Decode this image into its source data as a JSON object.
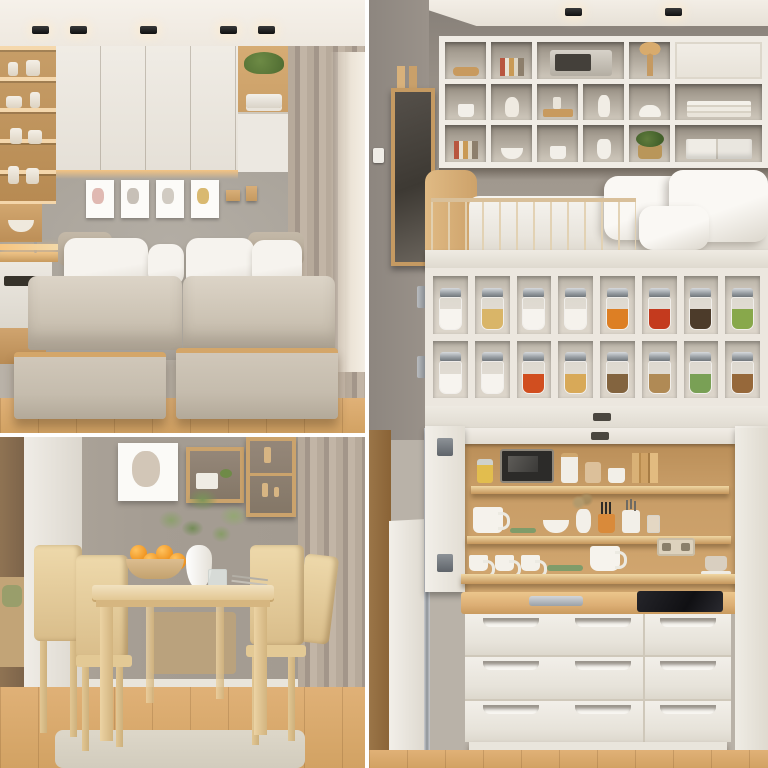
{
  "meta": {
    "kind": "photo-collage",
    "title": "Space-saving small apartment interiors — 3-photo collage",
    "layout": "two stacked photos left, one tall photo right, thin white dividers"
  },
  "palette": {
    "divider": "#ffffff",
    "ceiling": "#f5f0e9",
    "wall_bedroom": "#a6a097",
    "wall_dining": "#a59d93",
    "wall_kitchen": "#968e85",
    "cabinet_white": "#ece8e1",
    "wood": "#cfa36d",
    "wood_dark": "#b5854e",
    "floor_wood": "#d9a96c",
    "mattress_beige": "#cdc4b5",
    "pillow_white": "#f4f1ec",
    "curtain_taupe": "#b0a396",
    "spice_shell_cream": "#ece7df",
    "jar_lid_metal": "#9aa0a5",
    "cooktop_black": "#141417",
    "led_glow": "#f7c57f",
    "plant_green": "#5f7b3c",
    "orange_fruit": "#ef931f"
  },
  "photos": {
    "bedroom": {
      "label": "Compact bedroom: twin pull-out trundle beds under mattresses, white wall cabinets, wood display shelving, mini kitchenette, gray wall with art, taupe curtain",
      "ceiling_lights": 5,
      "cabinet_doors": 4,
      "wall_frames": [
        {
          "art": "pink botanical sketch",
          "tint": "#d8a9a0"
        },
        {
          "art": "gray leaf sketch",
          "tint": "#b9b2a6"
        },
        {
          "art": "heart line sketch",
          "tint": "#c6bfb4"
        },
        {
          "art": "gold floral sketch",
          "tint": "#cfa94e"
        }
      ],
      "mattresses": 2,
      "pillows": 4,
      "trundle_drawers": 2,
      "left_shelf_items": [
        "vases",
        "figurines",
        "candles",
        "bowls"
      ],
      "right_cubby_items": [
        "green plant",
        "folded towels"
      ],
      "kitchenette": [
        "faucet",
        "appliance with vent slot",
        "wood drawer"
      ]
    },
    "dining": {
      "label": "Dining nook: light wood table with four chairs, vase of greenery, bowl of oranges, framed art and wood box shelves on gray wall, taupe curtain, glimpse of bedroom through doorway",
      "chairs": 4,
      "oranges": 4,
      "table_items": [
        "wood bowl of oranges",
        "white vase with green sprigs",
        "water glass",
        "cutlery",
        "napkin"
      ],
      "wall_boxes": 2,
      "wall_art": {
        "art": "botanical sketch",
        "tint": "#c4b4a2"
      },
      "rug": "beige woven rug"
    },
    "kitchen_unit": {
      "label": "Fold-out kitchen cabinet wall: cubby shelving, loft bed with railing, spice jar rack, drop-down counter with shelves of dishes, drawer chest with cooktop",
      "ceiling_lights": 2,
      "wall_fixtures": [
        "wood-framed mirror board",
        "light switch"
      ],
      "cubby_rows": [
        [
          "wood-bowl",
          "books",
          "microwave:2",
          "flower",
          "door:2"
        ],
        [
          "cup",
          "figurine",
          "tray",
          "vase",
          "dome",
          "trays:2"
        ],
        [
          "books",
          "bowl-white",
          "cup",
          "pitcher",
          "plant",
          "boxes:2"
        ]
      ],
      "loft_bed": {
        "headboard": "curved wood",
        "railing_slats": 12,
        "pillows": 3,
        "bedding": "white duvet"
      },
      "spice_rack": {
        "rows": [
          [
            {
              "name": "salt",
              "color": "#f7f4ef"
            },
            {
              "name": "oat flakes",
              "color": "#d9b568"
            },
            {
              "name": "sugar",
              "color": "#f6f3ee"
            },
            {
              "name": "flour",
              "color": "#f5f2ec"
            },
            {
              "name": "red lentils",
              "color": "#dd7f24"
            },
            {
              "name": "chili flakes",
              "color": "#c43a1e"
            },
            {
              "name": "peppercorns",
              "color": "#4c3b2a"
            },
            {
              "name": "dried herbs",
              "color": "#88a84b"
            }
          ],
          [
            {
              "name": "salt",
              "color": "#f7f4ef"
            },
            {
              "name": "sugar",
              "color": "#f6f3ee"
            },
            {
              "name": "chili pieces",
              "color": "#d14e1f"
            },
            {
              "name": "turmeric",
              "color": "#d8a958"
            },
            {
              "name": "cumin seeds",
              "color": "#83643f"
            },
            {
              "name": "grains",
              "color": "#b08a55"
            },
            {
              "name": "herb mix",
              "color": "#79a055"
            },
            {
              "name": "cinnamon sticks",
              "color": "#96683a"
            }
          ]
        ]
      },
      "counter_shelves": {
        "top": [
          "jar-yellow",
          "screen",
          "can-white",
          "can-tan",
          "mug-print",
          "boards"
        ],
        "middle": [
          "mug-big",
          "dish-green",
          "bowl-white",
          "vase-sprigs",
          "cup-orange",
          "knife-jar",
          "jar-small"
        ],
        "counter": [
          "mug",
          "mug",
          "mug",
          "plate-green",
          "cup-big",
          "cup-saucer"
        ]
      },
      "counter_fixtures": [
        "power outlet",
        "open white doors with hinges",
        "center latch"
      ],
      "drawers": {
        "left_columns_rows": 3,
        "left_handles_per_drawer": 2,
        "right_rows": 3,
        "right_handles_per_drawer": 1
      },
      "countertop_items": [
        "metal tray",
        "black induction cooktop"
      ]
    }
  }
}
